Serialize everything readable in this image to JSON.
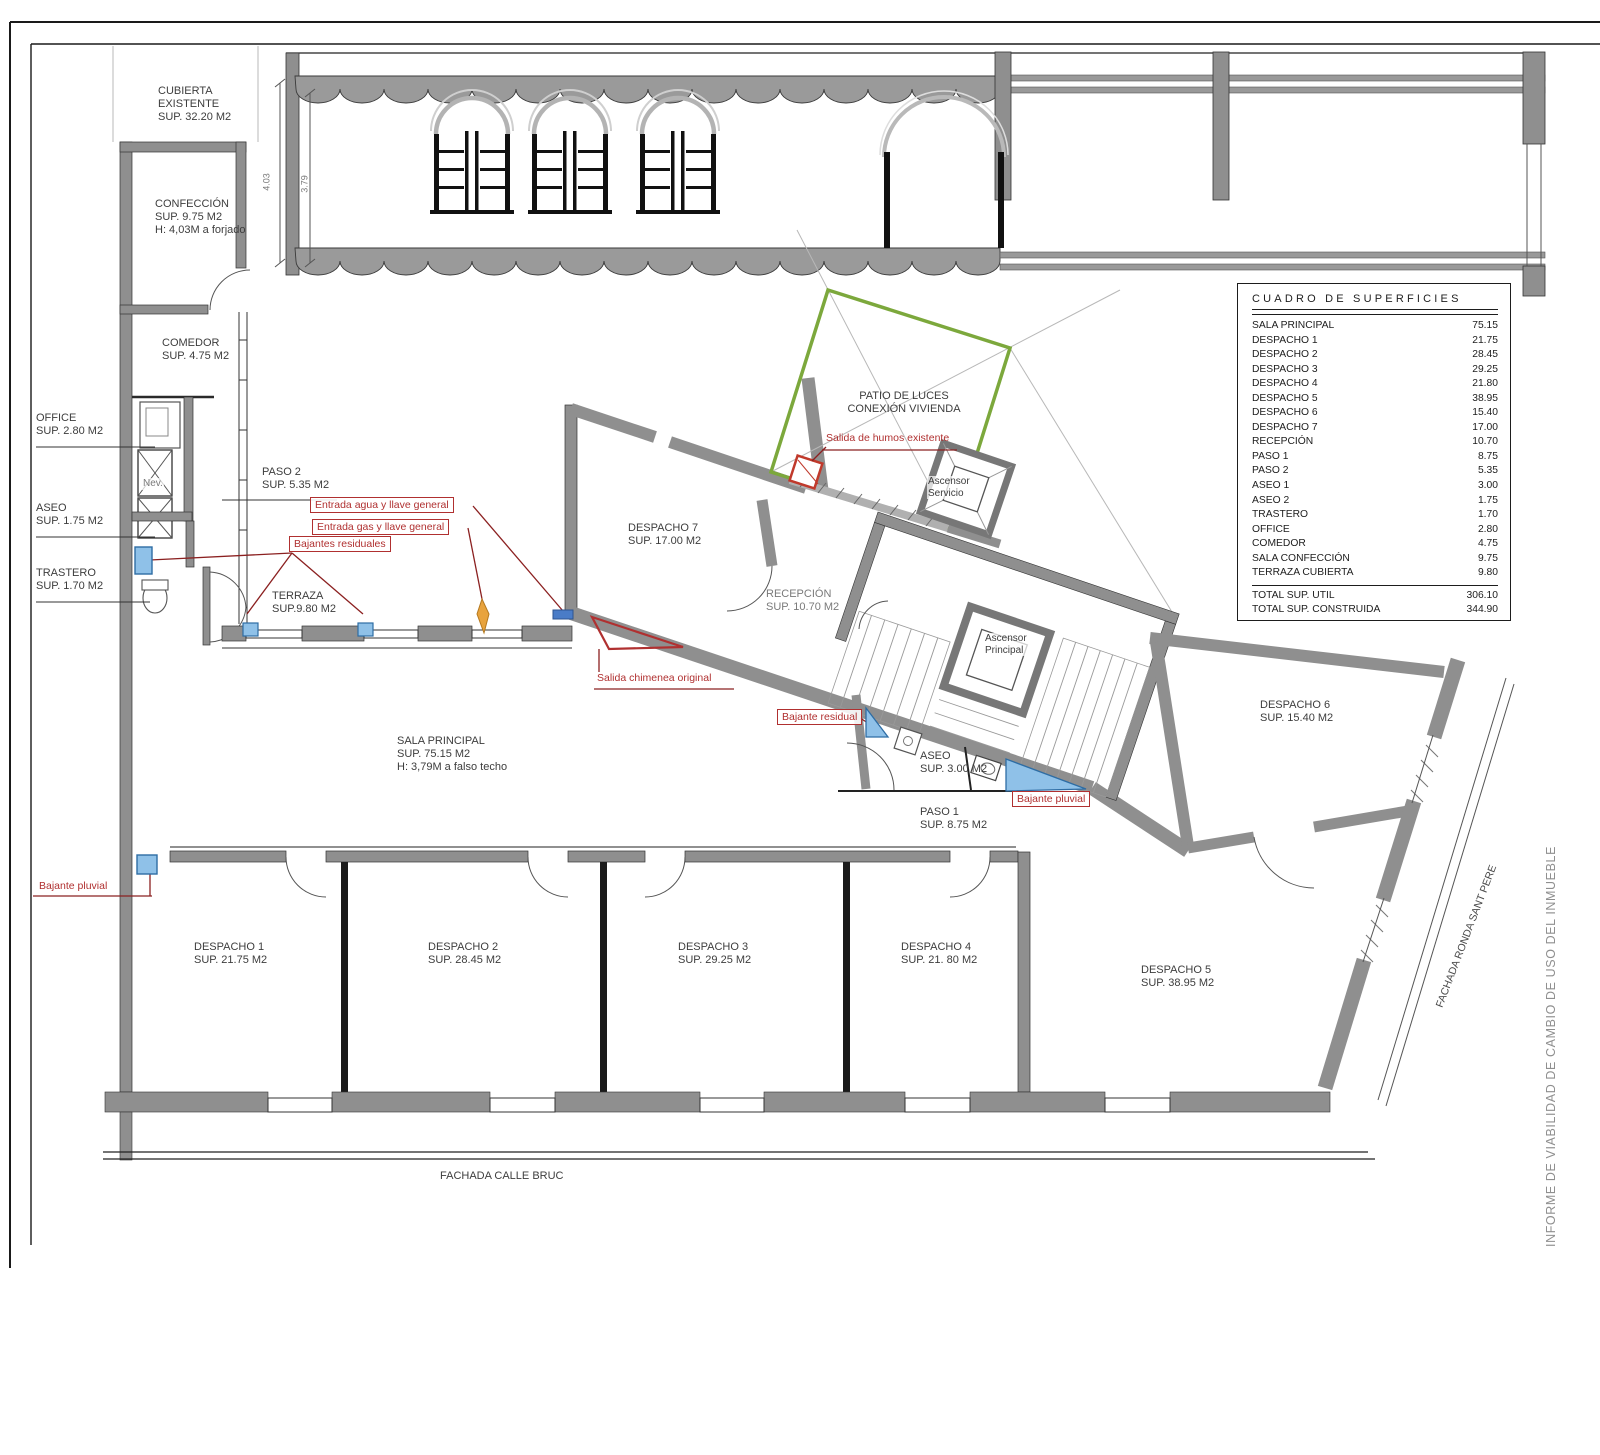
{
  "side_note": "INFORME DE VIABILIDAD DE CAMBIO DE USO DEL INMUEBLE",
  "facades": {
    "calle_bruc": "FACHADA CALLE BRUC",
    "ronda": "FACHADA RONDA SANT PERE"
  },
  "dims": [
    "4.03",
    "3.79"
  ],
  "plan": {
    "labels": {
      "cubierta": {
        "lines": [
          "CUBIERTA",
          "EXISTENTE",
          "SUP. 32.20 M2"
        ]
      },
      "confeccion": {
        "lines": [
          "CONFECCIÓN",
          "SUP. 9.75 M2",
          "H: 4,03M a forjado"
        ]
      },
      "comedor": {
        "lines": [
          "COMEDOR",
          "SUP. 4.75 M2"
        ]
      },
      "office": {
        "lines": [
          "OFFICE",
          "SUP. 2.80 M2"
        ]
      },
      "aseo_left": {
        "lines": [
          "ASEO",
          "SUP. 1.75 M2"
        ]
      },
      "trastero": {
        "lines": [
          "TRASTERO",
          "SUP. 1.70 M2"
        ]
      },
      "nevera": {
        "lines": [
          "Nev."
        ]
      },
      "paso2": {
        "lines": [
          "PASO 2",
          "SUP. 5.35 M2"
        ]
      },
      "terraza": {
        "lines": [
          "TERRAZA",
          "SUP.9.80 M2"
        ]
      },
      "despacho7": {
        "lines": [
          "DESPACHO 7",
          "SUP. 17.00 M2"
        ]
      },
      "patio": {
        "lines": [
          "PATIO DE LUCES",
          "CONEXIÓN VIVIENDA"
        ]
      },
      "recepcion": {
        "lines": [
          "RECEPCIÓN",
          "SUP. 10.70 M2"
        ]
      },
      "asc_servicio": {
        "lines": [
          "Ascensor",
          "Servicio"
        ]
      },
      "asc_principal": {
        "lines": [
          "Ascensor",
          "Principal"
        ]
      },
      "aseo_right": {
        "lines": [
          "ASEO",
          "SUP. 3.00 M2"
        ]
      },
      "paso1": {
        "lines": [
          "PASO 1",
          "SUP. 8.75 M2"
        ]
      },
      "sala": {
        "lines": [
          "SALA PRINCIPAL",
          "SUP. 75.15 M2",
          "H: 3,79M a falso techo"
        ]
      },
      "despacho1": {
        "lines": [
          "DESPACHO 1",
          "SUP. 21.75 M2"
        ]
      },
      "despacho2": {
        "lines": [
          "DESPACHO 2",
          "SUP. 28.45 M2"
        ]
      },
      "despacho3": {
        "lines": [
          "DESPACHO 3",
          "SUP. 29.25 M2"
        ]
      },
      "despacho4": {
        "lines": [
          "DESPACHO 4",
          "SUP. 21. 80 M2"
        ]
      },
      "despacho5": {
        "lines": [
          "DESPACHO 5",
          "SUP. 38.95 M2"
        ]
      },
      "despacho6": {
        "lines": [
          "DESPACHO 6",
          "SUP. 15.40 M2"
        ]
      }
    }
  },
  "annotations": {
    "entrada_agua": "Entrada agua y llave general",
    "entrada_gas": "Entrada gas y llave general",
    "bajantes_residuales": "Bajantes residuales",
    "salida_humos": "Salida de humos existente",
    "salida_chimenea": "Salida chimenea original",
    "bajante_residual": "Bajante residual",
    "bajante_pluvial_right": "Bajante pluvial",
    "bajante_pluvial_left": "Bajante pluvial"
  },
  "table": {
    "title": "CUADRO DE SUPERFICIES",
    "rows": [
      {
        "name": "SALA PRINCIPAL",
        "value": "75.15"
      },
      {
        "name": "DESPACHO 1",
        "value": "21.75"
      },
      {
        "name": "DESPACHO 2",
        "value": "28.45"
      },
      {
        "name": "DESPACHO 3",
        "value": "29.25"
      },
      {
        "name": "DESPACHO 4",
        "value": "21.80"
      },
      {
        "name": "DESPACHO 5",
        "value": "38.95"
      },
      {
        "name": "DESPACHO 6",
        "value": "15.40"
      },
      {
        "name": "DESPACHO 7",
        "value": "17.00"
      },
      {
        "name": "RECEPCIÓN",
        "value": "10.70"
      },
      {
        "name": "PASO 1",
        "value": "8.75"
      },
      {
        "name": "PASO 2",
        "value": "5.35"
      },
      {
        "name": "ASEO 1",
        "value": "3.00"
      },
      {
        "name": "ASEO 2",
        "value": "1.75"
      },
      {
        "name": "TRASTERO",
        "value": "1.70"
      },
      {
        "name": "OFFICE",
        "value": "2.80"
      },
      {
        "name": "COMEDOR",
        "value": "4.75"
      },
      {
        "name": "SALA CONFECCIÓN",
        "value": "9.75"
      },
      {
        "name": "TERRAZA CUBIERTA",
        "value": "9.80"
      }
    ],
    "totals": [
      {
        "label": "TOTAL SUP. UTIL",
        "value": "306.10"
      },
      {
        "label": "TOTAL SUP. CONSTRUIDA",
        "value": "344.90"
      }
    ]
  },
  "colors": {
    "wall": "#8f8f8f",
    "annotation_red": "#b03030",
    "patio_green": "#7ca83c",
    "water_blue": "#8fc1e8",
    "orange": "#e8a33d"
  }
}
